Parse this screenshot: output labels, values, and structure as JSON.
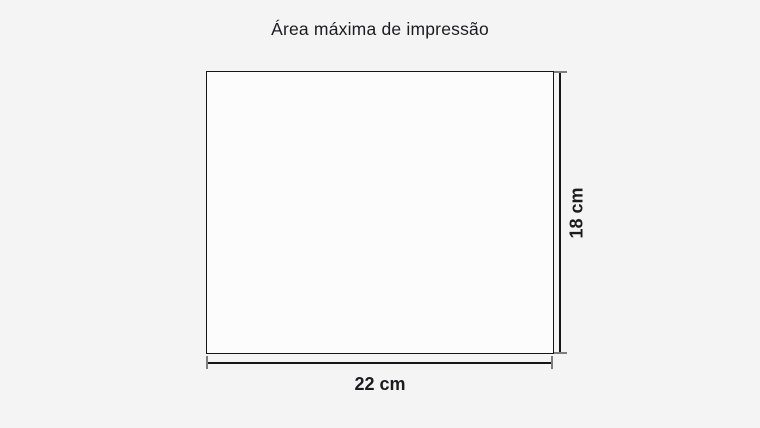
{
  "title": "Área máxima de impressão",
  "diagram": {
    "type": "dimension-drawing",
    "subject": "maximum print area",
    "width_label": "22 cm",
    "height_label": "18 cm",
    "width_value_cm": 22,
    "height_value_cm": 18,
    "colors": {
      "background": "#f4f4f5",
      "area_fill": "#fcfcfc",
      "line": "#151515",
      "cap": "#7d7d7d",
      "text": "#1c1c1e"
    }
  }
}
